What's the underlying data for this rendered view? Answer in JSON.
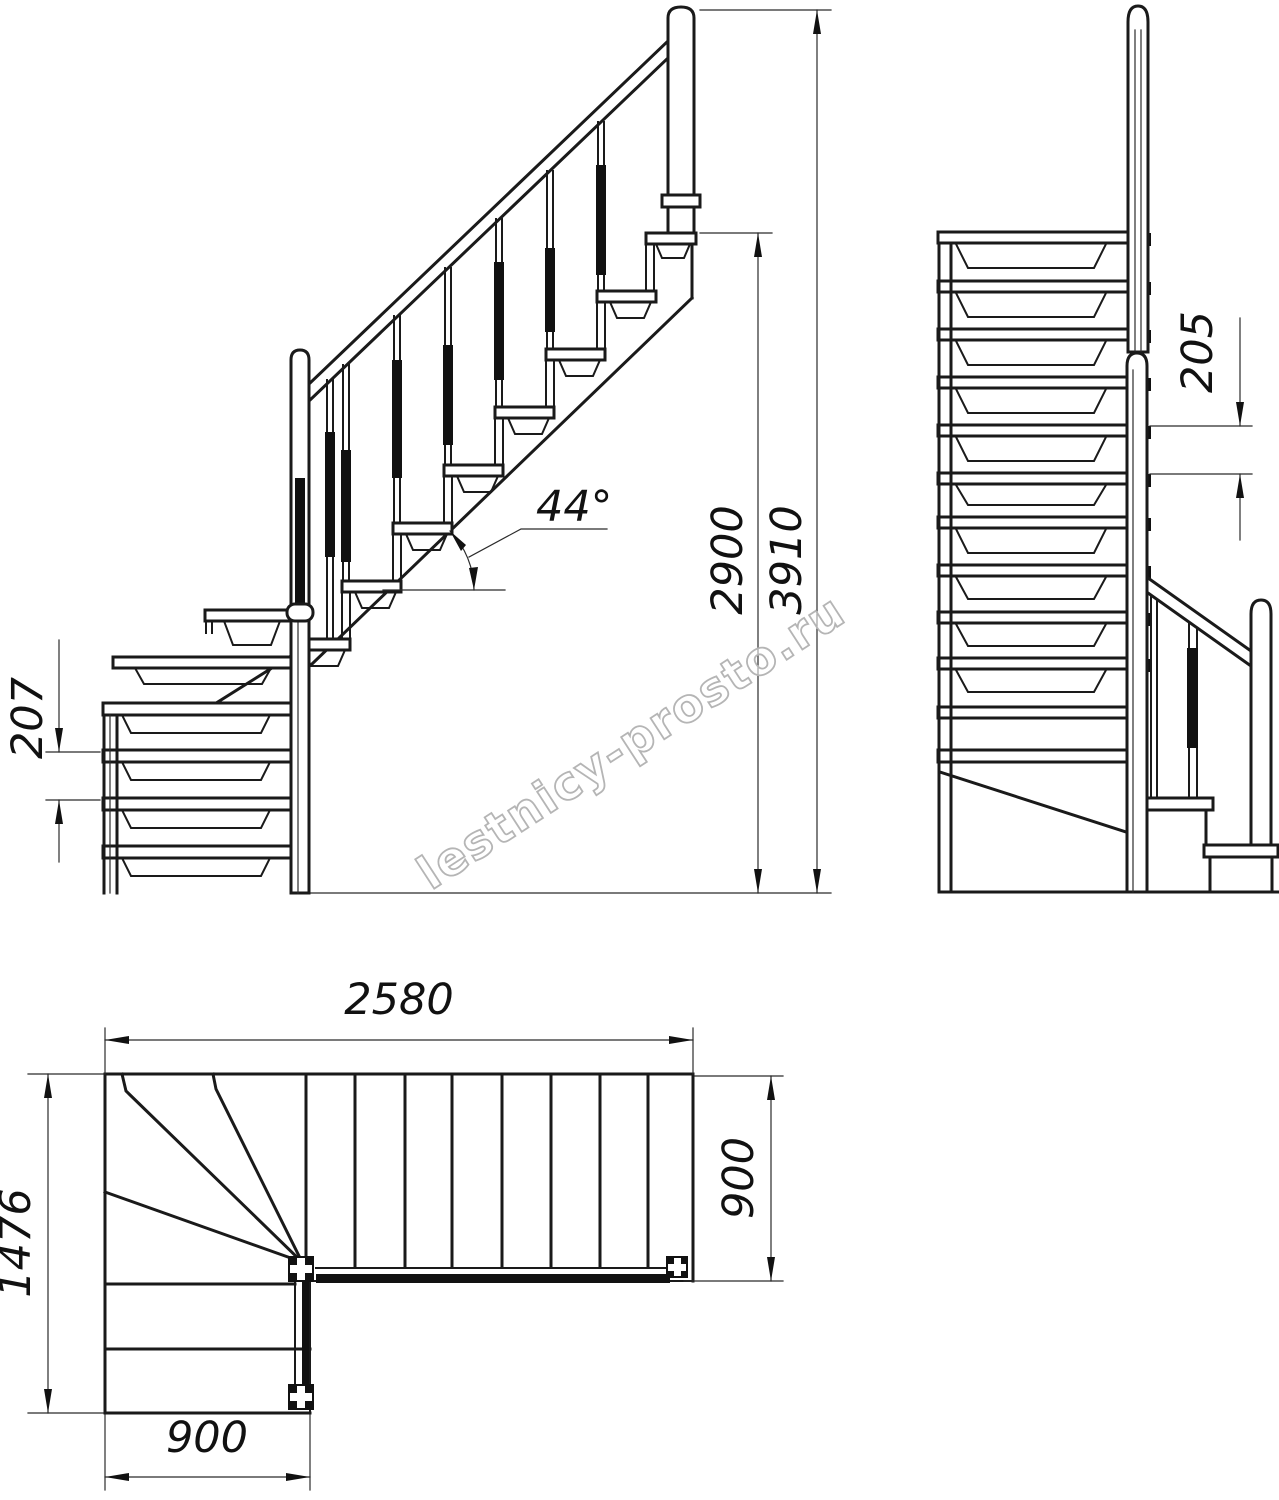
{
  "watermark": {
    "text": "lestnicy-prosto.ru",
    "color": "#b5b5b5"
  },
  "colors": {
    "drawing_line": "#1a1a1a",
    "background": "#ffffff"
  },
  "side_view": {
    "label": "side elevation of L-shaped staircase",
    "lower_flight_rise": "207",
    "slope_angle": "44°",
    "flight_height": "2900",
    "total_height": "3910"
  },
  "front_view": {
    "label": "front elevation of staircase",
    "step_rise": "205"
  },
  "plan_view": {
    "label": "plan of staircase with winder corner",
    "upper_run_length": "2580",
    "total_depth": "1476",
    "lower_run_width": "900",
    "upper_run_width": "900"
  }
}
